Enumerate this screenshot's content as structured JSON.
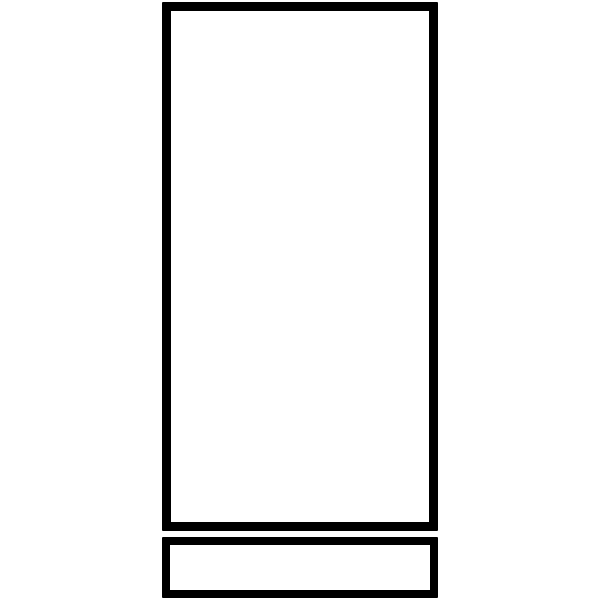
{
  "canvas": {
    "width": 600,
    "height": 600,
    "background": "#ffffff"
  },
  "diagram": {
    "description": "Black outline line drawing: a tall upright rectangle with a short wide rectangle directly beneath it",
    "stroke_color": "#000000",
    "fill_color": "#ffffff",
    "shapes": [
      {
        "name": "main-panel-rect",
        "type": "rect",
        "x": 162,
        "y": 2,
        "width": 276,
        "height": 529,
        "stroke_width": 9
      },
      {
        "name": "base-panel-rect",
        "type": "rect",
        "x": 162,
        "y": 537,
        "width": 276,
        "height": 61,
        "stroke_width": 8
      }
    ]
  }
}
